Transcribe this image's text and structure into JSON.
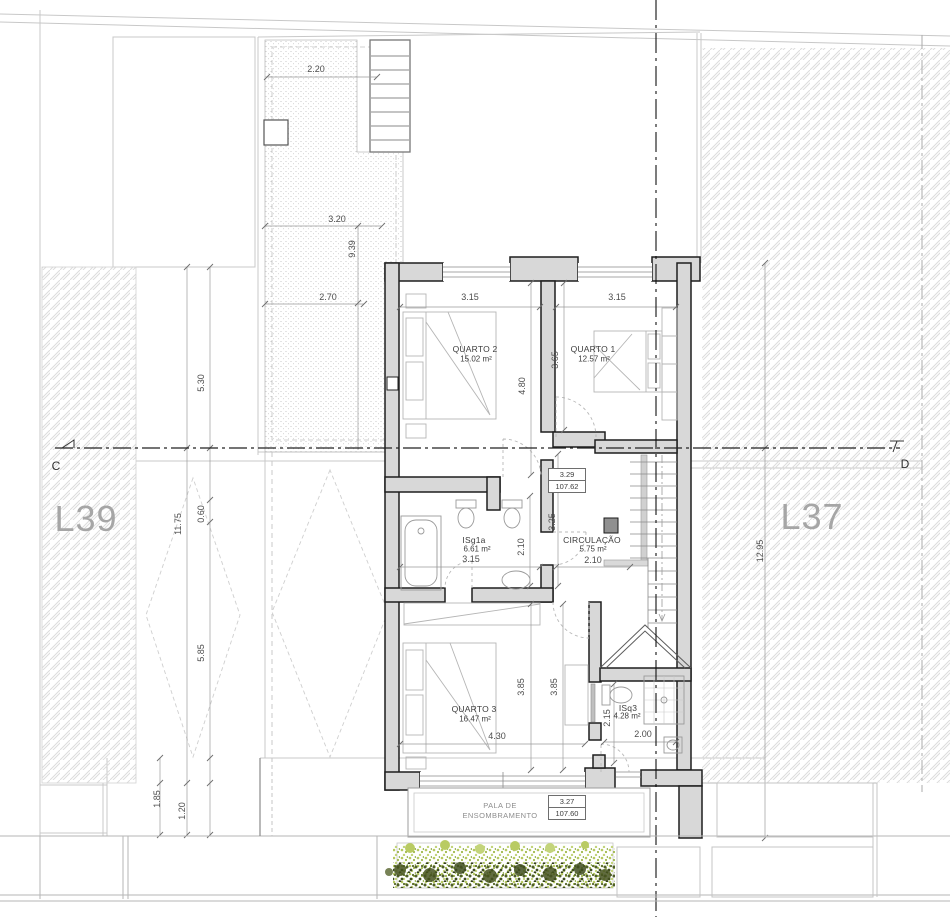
{
  "lots": {
    "left": "L39",
    "right": "L37"
  },
  "section_markers": {
    "left": "C",
    "right": "D"
  },
  "rooms": {
    "quarto2": {
      "name": "QUARTO 2",
      "area": "15.02 m²"
    },
    "quarto1": {
      "name": "QUARTO 1",
      "area": "12.57 m²"
    },
    "isg1a": {
      "name": "ISg1a",
      "area": "6.61 m²",
      "width": "3.15"
    },
    "circulacao": {
      "name": "CIRCULAÇÃO",
      "area": "5.75 m²",
      "width": "2.10"
    },
    "quarto3": {
      "name": "QUARTO 3",
      "area": "16.47 m²",
      "width": "4.30"
    },
    "isq3": {
      "name": "ISq3",
      "area": "4.28 m²",
      "width": "2.00"
    }
  },
  "levels": {
    "upper": {
      "value": "3.29",
      "elevation": "107.62"
    },
    "lower": {
      "value": "3.27",
      "elevation": "107.60"
    }
  },
  "pala": {
    "line1": "PALA DE",
    "line2": "ENSOMBRAMENTO"
  },
  "dims": {
    "patio_top": "2.20",
    "patio_mid": "3.20",
    "patio_len": "9.39",
    "patio_low": "2.70",
    "left_a": "5.30",
    "left_b": "11.75",
    "left_c": "0.60",
    "left_d": "5.85",
    "left_e": "1.85",
    "left_f": "1.20",
    "right_a": "12.95",
    "q2_w": "3.15",
    "q1_w": "3.15",
    "q2_h": "4.80",
    "q1_h": "3.65",
    "circ_h": "3.25",
    "bath_h": "2.10",
    "q3_h1": "3.85",
    "q3_h2": "3.85",
    "isq3_h": "2.15"
  }
}
